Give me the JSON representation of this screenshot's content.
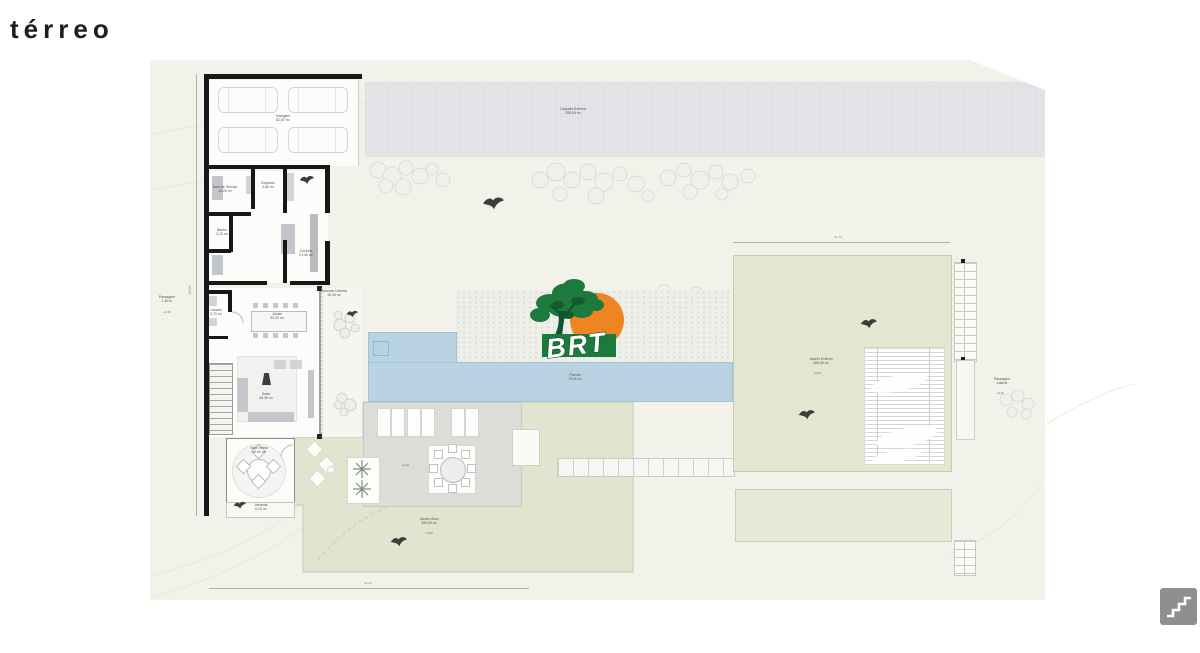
{
  "title": "térreo",
  "logo": {
    "text": "BRT"
  },
  "plan": {
    "dimensions": {
      "top_right": "21,70",
      "bottom_left": "32,45",
      "left_side": "28,90"
    },
    "labels": {
      "sidewalk": {
        "name": "Calçada Externa",
        "area": "258,00 m²"
      },
      "garage": {
        "name": "Garagem",
        "area": "52,57 m²"
      },
      "service": {
        "name": "Área de Serviço",
        "area": "10,20 m²"
      },
      "storage": {
        "name": "Depósito",
        "area": "3,80 m²"
      },
      "bath": {
        "name": "Banho",
        "area": "3,20 m²"
      },
      "kitchen": {
        "name": "Cozinha",
        "area": "21,40 m²"
      },
      "lavabo": {
        "name": "Lavabo",
        "area": "2,70 m²"
      },
      "dining": {
        "name": "Jantar",
        "area": "34,20 m²"
      },
      "living": {
        "name": "Estar",
        "area": "46,30 m²"
      },
      "veranda_right": {
        "name": "Varanda Coberta",
        "area": "16,40 m²"
      },
      "gourmet": {
        "name": "Sala Íntima",
        "area": "18,60 m²"
      },
      "veranda_bottom": {
        "name": "Varanda",
        "area": "6,10 m²"
      },
      "pool": {
        "name": "Piscina",
        "area": "75,00 m²"
      },
      "deck": {
        "level": "+0,10"
      },
      "lawn": {
        "name": "Jardim Área",
        "area": "320,00 m²",
        "level": "+0,00"
      },
      "garden_right": {
        "name": "Jardim Externo",
        "area": "468,00 m²",
        "level": "+0,00"
      },
      "passage_right": {
        "name": "Passagem",
        "detail": "Lateral",
        "level": "+0,15"
      },
      "passage_left": {
        "name": "Passagem",
        "detail": "1,50 m",
        "level": "+0,15"
      }
    }
  }
}
